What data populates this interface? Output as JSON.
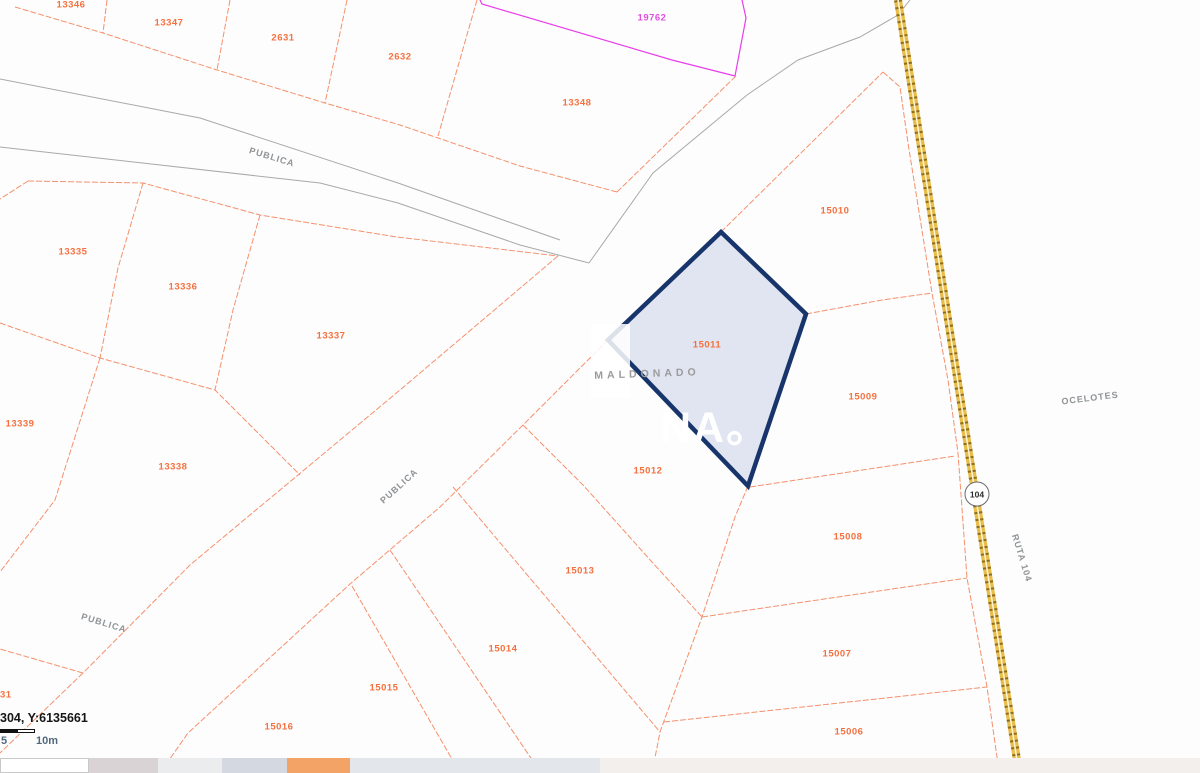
{
  "map": {
    "selected_parcel_id": "15011",
    "parcel_labels": {
      "p13346": "13346",
      "p13347": "13347",
      "p2631": "2631",
      "p2632": "2632",
      "p19762": "19762",
      "p13348": "13348",
      "p13335": "13335",
      "p13336": "13336",
      "p13337": "13337",
      "p13339": "13339",
      "p13338": "13338",
      "p15010": "15010",
      "p15011": "15011",
      "p15009": "15009",
      "p15012": "15012",
      "p15013": "15013",
      "p15014": "15014",
      "p15015": "15015",
      "p15016": "15016",
      "p15008": "15008",
      "p15007": "15007",
      "p15006": "15006",
      "p31": "31"
    },
    "road_labels": {
      "publica_top": "PUBLICA",
      "publica_diagonal": "PUBLICA",
      "publica_bottom": "PUBLICA",
      "ocelotes": "OCELOTES",
      "ruta_104": "RUTA 104",
      "route_shield": "104"
    },
    "watermark": {
      "department": "MALDONADO",
      "logo_fragment": "NA。"
    },
    "colors": {
      "parcel_line": "#f5906c",
      "parcel_label": "#f4713f",
      "special_parcel_line": "#e93ee9",
      "road_line": "#a9a9a9",
      "selected_outline": "#17356b",
      "selected_fill": "#dde3f0",
      "route_gold": "#e9bd4a",
      "route_dark": "#8d6e1e",
      "strip_orange": "#f2a365"
    }
  },
  "statusbar": {
    "coordinates": "304, Y:6135661",
    "scale_mid_label": "5",
    "scale_end_label": "10m"
  }
}
